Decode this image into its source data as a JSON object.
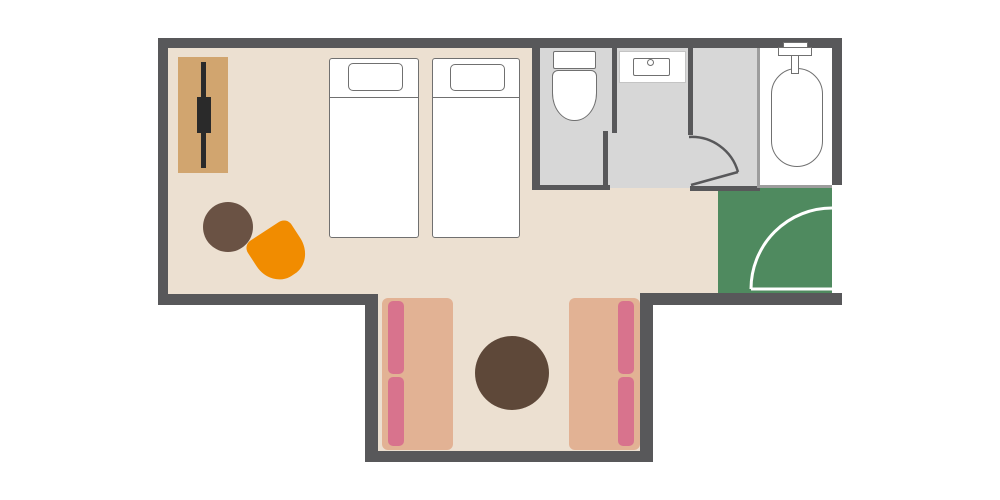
{
  "palette": {
    "wall": "#58585a",
    "floor_main": "#ece0d1",
    "floor_bath": "#d7d7d7",
    "floor_tub": "#ffffff",
    "floor_entry": "#4f8a5f",
    "divider_light": "#9d9d9d",
    "fixture_outline": "#707070",
    "fixture_fill": "#ffffff",
    "vanity_outline": "#c4c4c4",
    "door_white": "#ffffff",
    "tv_board": "#d1a56f",
    "tv": "#2a2a2a",
    "table_main": "#6a5244",
    "table_alcove": "#5e4839",
    "chair": "#f18c00",
    "sofa": "#e2b294",
    "cushion": "#d8738d",
    "bed": "#ffffff"
  },
  "floorplan": {
    "type": "hotel-twin-room-floor-plan",
    "rooms": [
      {
        "name": "bedroom",
        "floor_color": "floor_main"
      },
      {
        "name": "lounge-alcove",
        "floor_color": "floor_main"
      },
      {
        "name": "toilet-room",
        "floor_color": "floor_bath"
      },
      {
        "name": "washroom",
        "floor_color": "floor_bath"
      },
      {
        "name": "bathtub-room",
        "floor_color": "floor_tub"
      },
      {
        "name": "entryway",
        "floor_color": "floor_entry"
      }
    ],
    "furniture": [
      {
        "name": "tv-board"
      },
      {
        "name": "tv"
      },
      {
        "name": "round-side-table"
      },
      {
        "name": "orange-armchair"
      },
      {
        "name": "single-bed",
        "count": 2
      },
      {
        "name": "sofa",
        "count": 2
      },
      {
        "name": "round-coffee-table"
      },
      {
        "name": "toilet"
      },
      {
        "name": "washbasin"
      },
      {
        "name": "bathtub"
      },
      {
        "name": "entry-door"
      },
      {
        "name": "washroom-door"
      }
    ]
  }
}
